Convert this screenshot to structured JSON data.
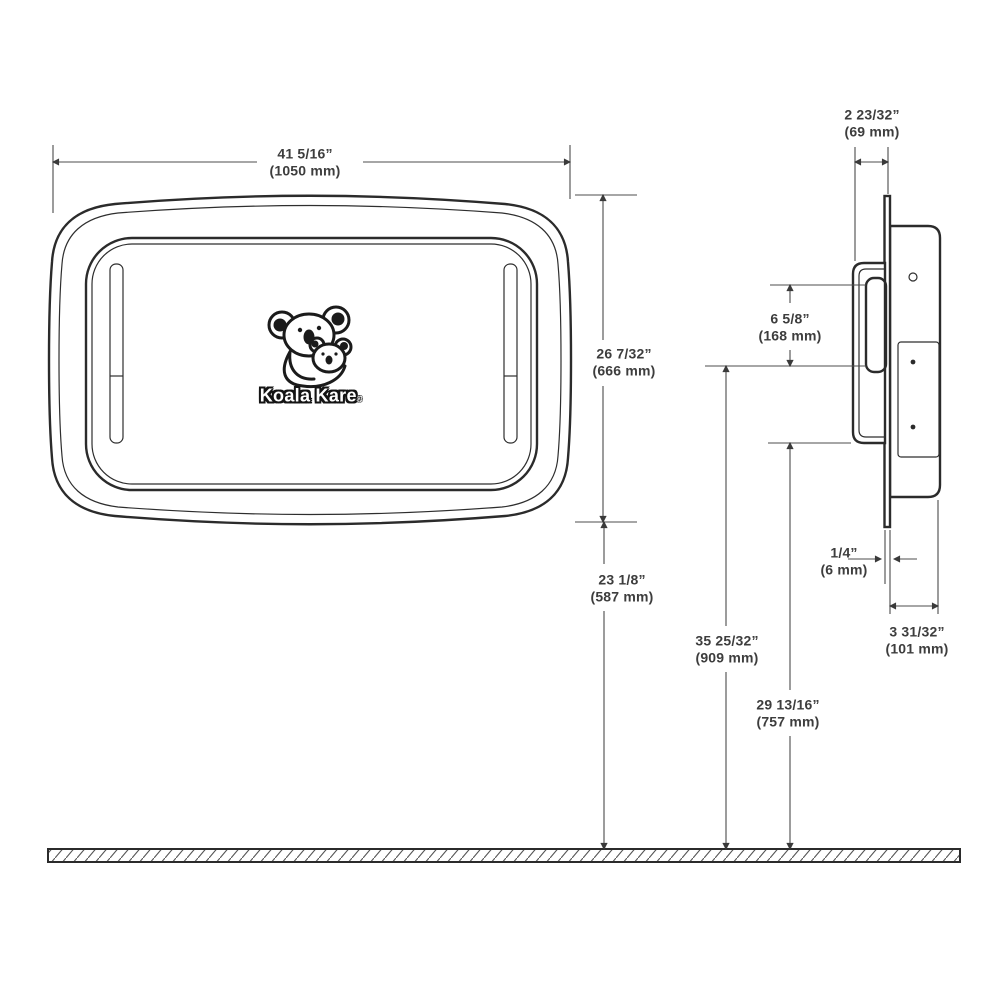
{
  "logo": {
    "brand": "Koala Kare",
    "mark": "®"
  },
  "colors": {
    "outline": "#2b2b2b",
    "dimension_lines": "#4c4c4c",
    "label_text": "#3d3d3d",
    "background": "#ffffff"
  },
  "dims": {
    "overall_width": {
      "in": "41 5/16”",
      "mm": "(1050 mm)"
    },
    "projection_from_wall": {
      "in": "2 23/32”",
      "mm": "(69 mm)"
    },
    "overall_height": {
      "in": "26 7/32”",
      "mm": "(666 mm)"
    },
    "handle_height": {
      "in": "6 5/8”",
      "mm": "(168 mm)"
    },
    "floor_to_unit_bottom": {
      "in": "23 1/8”",
      "mm": "(587 mm)"
    },
    "floor_to_handle_top": {
      "in": "35 25/32”",
      "mm": "(909 mm)"
    },
    "floor_to_handle_bottom": {
      "in": "29 13/16”",
      "mm": "(757 mm)"
    },
    "wall_panel_thickness": {
      "in": "1/4”",
      "mm": "(6 mm)"
    },
    "recess_depth": {
      "in": "3 31/32”",
      "mm": "(101 mm)"
    }
  }
}
